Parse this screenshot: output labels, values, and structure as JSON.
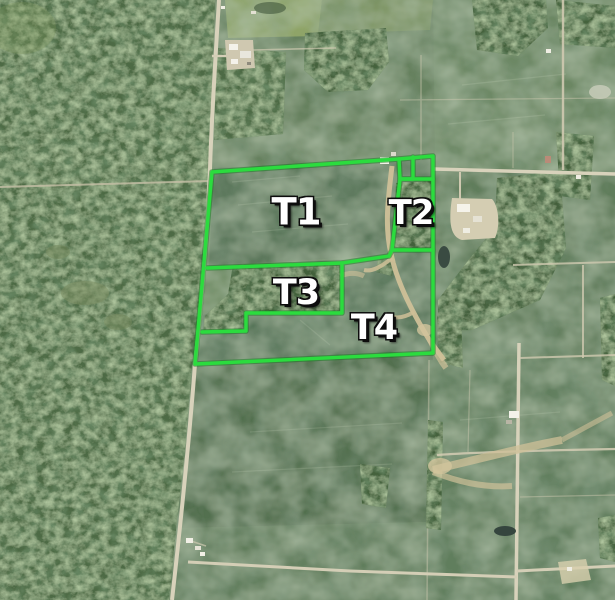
{
  "map": {
    "tracts": [
      {
        "label": "T1"
      },
      {
        "label": "T2"
      },
      {
        "label": "T3"
      },
      {
        "label": "T4"
      }
    ],
    "boundary_color": "#2BDC3E",
    "label_text_color": "#FFFFFF"
  }
}
